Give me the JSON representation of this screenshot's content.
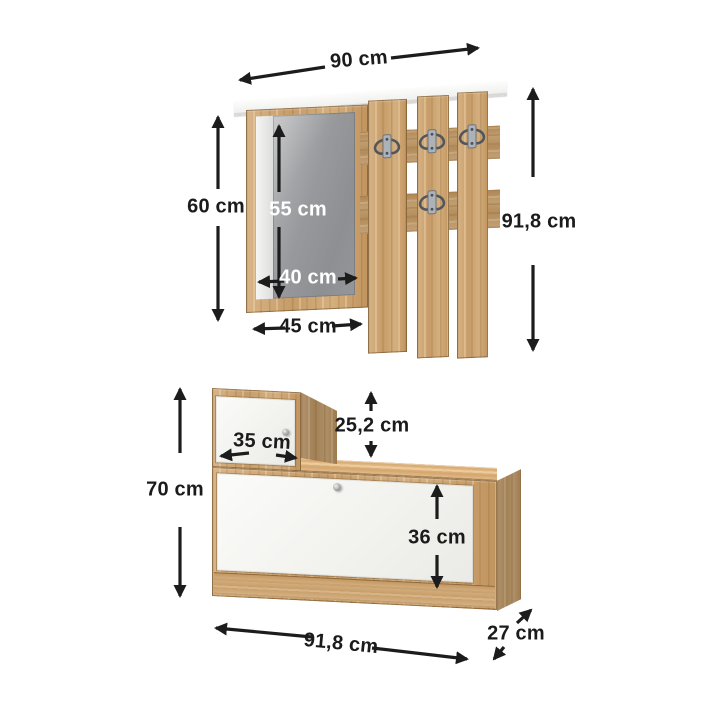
{
  "diagram": {
    "type": "furniture-dimension-diagram",
    "dimensions": {
      "top_width": "90 cm",
      "mirror_frame_height": "60 cm",
      "mirror_height": "55 cm",
      "mirror_width": "40 cm",
      "mirror_frame_width": "45 cm",
      "wall_panel_height": "91,8 cm",
      "small_door_width": "35 cm",
      "small_cabinet_height": "25,2 cm",
      "lower_unit_height": "70 cm",
      "flap_door_height": "36 cm",
      "lower_unit_width": "91,8 cm",
      "lower_unit_depth": "27 cm"
    },
    "colors": {
      "background": "#ffffff",
      "wood": "#cda97a",
      "wood_dark": "#b08855",
      "mirror_gray": "#98999c",
      "door_white": "#f7f7f4",
      "shelf_white": "#fdfdfc",
      "arrow_black": "#1c1c1c",
      "hook_metal": "#adb2b8"
    }
  }
}
